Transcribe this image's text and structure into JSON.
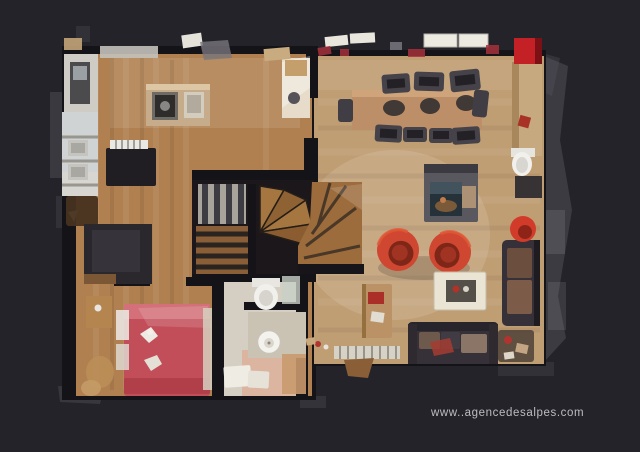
{
  "page": {
    "background": "#242329",
    "watermark_text": "www..agencedesalpes.com"
  },
  "colors": {
    "background": "#242329",
    "wall": "#141318",
    "ghost": "#55545c",
    "wood_left": "#b08050",
    "wood_living": "#c09e74",
    "stair_wood": "#9c6c3c",
    "stair_dark": "#2a2420",
    "bed_red": "#c24e59",
    "bed_highlight": "#d4727b",
    "armchair_red": "#cf4730",
    "accent_red": "#c42127",
    "sofa_dark": "#363138",
    "cushion_brown": "#6e5a4c",
    "table_wood": "#bd8f68",
    "chair_dark": "#454349",
    "bath_floor": "#d5cfc3",
    "fixture_white": "#f2f0ec",
    "counter_white": "#d8d6d1",
    "island_top": "#c6ac8a",
    "fireplace_body": "#59585e",
    "fireplace_glass": "#26323a",
    "coffee_table": "#eae4d4",
    "watermark": "#bdbdc1"
  }
}
